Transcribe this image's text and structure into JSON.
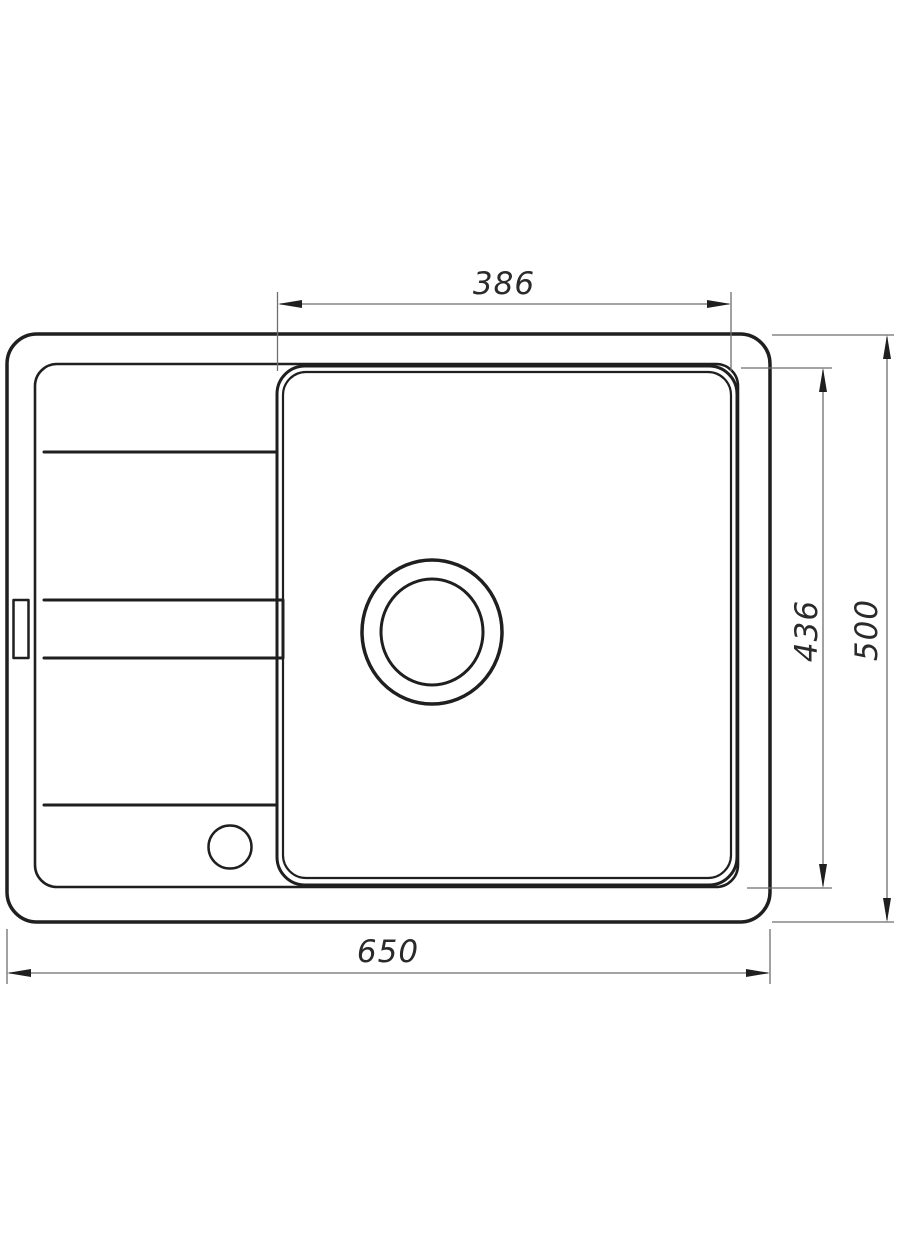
{
  "drawing": {
    "labels": {
      "bowl_width": "386",
      "bowl_depth": "436",
      "overall_depth": "500",
      "overall_width": "650"
    },
    "colors": {
      "background": "#ffffff",
      "outline": "#1f1f1f",
      "dimension_line": "#6e6e6e",
      "label_text": "#2a2a2a"
    }
  }
}
